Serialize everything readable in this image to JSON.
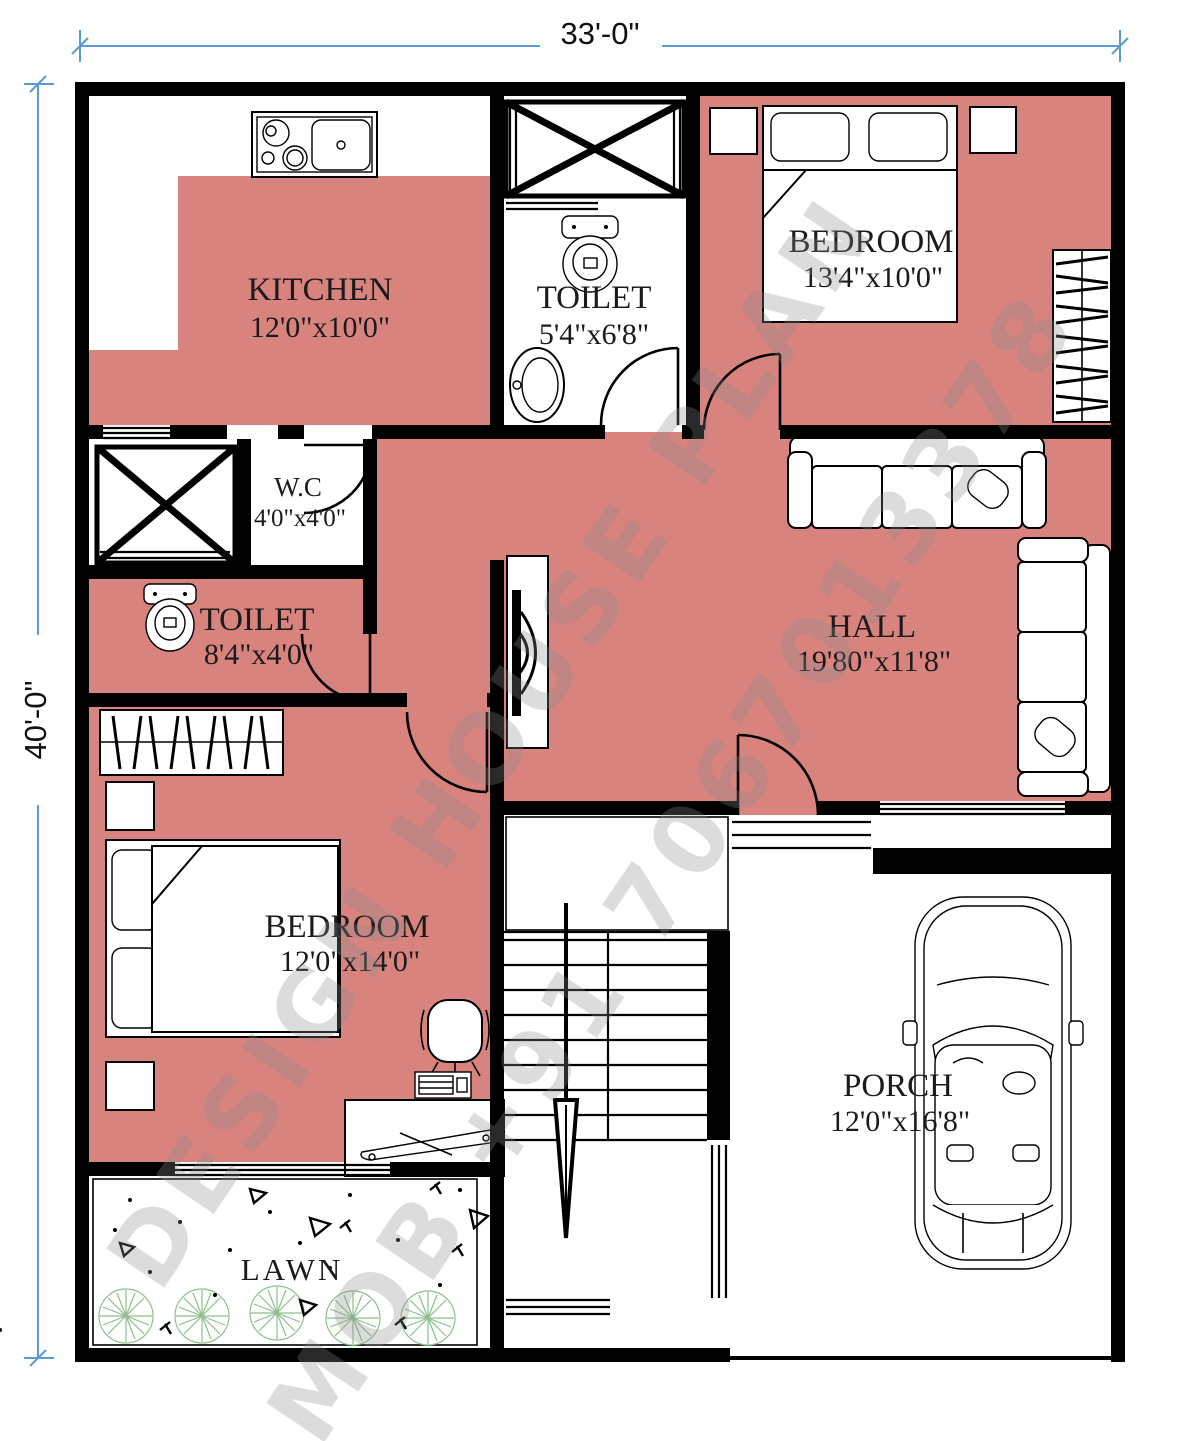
{
  "plan": {
    "dimensions": {
      "width_label": "33'-0\"",
      "height_label": "40'-0\""
    },
    "rooms": [
      {
        "id": "kitchen",
        "name": "KITCHEN",
        "size": "12'0\"x10'0\""
      },
      {
        "id": "toilet_top",
        "name": "TOILET",
        "size": "5'4\"x6'8\""
      },
      {
        "id": "bedroom_top",
        "name": "BEDROOM",
        "size": "13'4\"x10'0\""
      },
      {
        "id": "wc",
        "name": "W.C",
        "size": "4'0\"x4'0\""
      },
      {
        "id": "toilet_left",
        "name": "TOILET",
        "size": "8'4\"x4'0\""
      },
      {
        "id": "hall",
        "name": "HALL",
        "size": "19'80\"x11'8\""
      },
      {
        "id": "bedroom_bottom",
        "name": "BEDROOM",
        "size": "12'0\"x14'0\""
      },
      {
        "id": "porch",
        "name": "PORCH",
        "size": "12'0\"x16'8\""
      },
      {
        "id": "lawn",
        "name": "LAWN",
        "size": ""
      }
    ],
    "watermark": {
      "line1": "DESIGN HOUSE PLAN",
      "line2": "MOB +91 7067013378"
    },
    "colors": {
      "room_fill": "#d9837f",
      "wall": "#000000",
      "dimension": "#5b9bd5",
      "tree": "#8fbe8f"
    }
  }
}
